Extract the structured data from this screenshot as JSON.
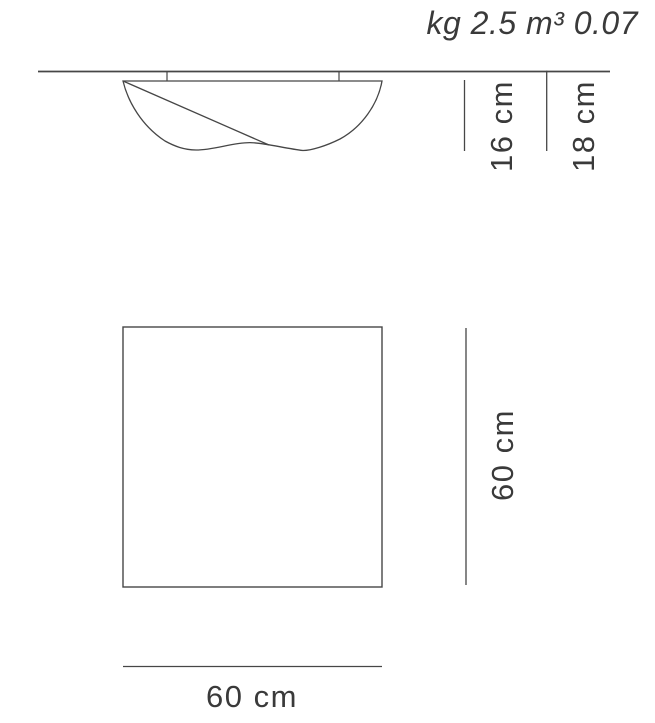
{
  "sheet": {
    "specs_label": "kg 2.5 m³ 0.07",
    "side_view": {
      "fixture_height": "16 cm",
      "total_height": "18 cm"
    },
    "front_view": {
      "height": "60 cm",
      "width": "60 cm"
    },
    "colors": {
      "line": "#464646",
      "text": "#3a3a3a",
      "background": "#ffffff"
    }
  }
}
